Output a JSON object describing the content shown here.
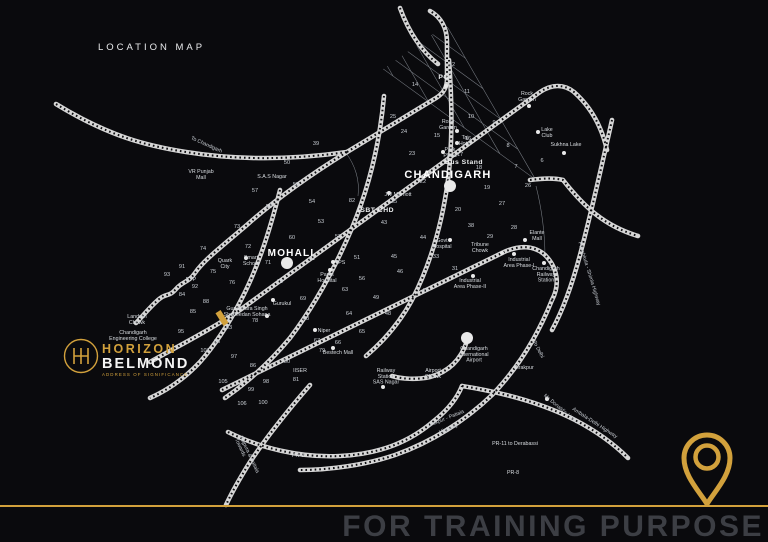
{
  "title": "LOCATION MAP",
  "watermark": "FOR TRAINING PURPOSE",
  "branding": {
    "monogram": "H",
    "name_line1": "HORIZON",
    "name_line2": "BELMOND",
    "tagline": "ADDRESS OF SIGNIFICANCE"
  },
  "colors": {
    "background": "#0a0a0d",
    "gold": "#d2a13c",
    "road": "#d6d6d6",
    "road_dash": "#0c0c0f",
    "grid_line": "#959ba3",
    "label": "#d9dde1",
    "watermark_text": "#3c3e44"
  },
  "map": {
    "grid": {
      "origin": [
        448,
        28
      ],
      "angle_a_deg": 216,
      "angle_b_deg": 60,
      "len_a": 420,
      "len_b": 175,
      "step_a": 44,
      "step_b": 35,
      "subdiv_from": 240,
      "clip_polygon": "450,22 544,186 218,424 114,258"
    },
    "roads": [
      "M56,104 C110,137 148,146 186,152 C248,162 305,158 347,152",
      "M347,152 L436,98 C444,93 447,87 447,79 L447,42 C447,28 441,17 430,11",
      "M400,8 C408,30 420,50 438,64",
      "M347,152 C310,175 275,200 248,224 C220,248 204,260 195,273 C188,283 183,281 176,289 C168,298 167,292 158,300 C148,309 143,316 136,323",
      "M150,362 C180,345 210,330 240,310 L540,92 C552,84 564,84 574,92 C592,108 602,128 607,150",
      "M222,390 L502,253 C520,244 535,246 545,255 C558,268 560,285 552,300",
      "M552,300 C538,335 518,368 492,395 C466,420 432,442 395,455 C365,465 330,470 300,470",
      "M449,60 C452,100 453,140 448,180 C442,225 430,265 412,300 C400,322 385,340 366,356",
      "M384,96 C380,140 370,185 352,228 C335,268 315,305 290,338 C270,362 248,382 225,398",
      "M280,190 C270,230 258,268 240,302 C228,325 215,345 200,362 C185,378 168,390 150,398",
      "M467,341 C461,360 448,372 430,377 C416,380 402,379 392,376",
      "M228,432 C260,448 300,458 340,456 C380,454 410,442 435,420 C450,408 458,396 462,386",
      "M310,385 C290,408 268,435 250,462 C240,478 232,492 226,505",
      "M462,386 C500,392 540,402 575,420 C598,432 615,445 628,458",
      "M612,120 C603,160 592,210 580,255 C572,285 563,310 552,330",
      "M530,180 C545,178 555,178 563,180 C585,208 605,226 638,236"
    ],
    "extra_thin": [
      "M346,153 C355,165 360,180 358,196",
      "M536,186 C542,210 545,235 545,258"
    ],
    "city_labels": [
      {
        "text": "CHANDIGARH",
        "x": 448,
        "y": 178,
        "size": 11
      },
      {
        "text": "MOHALI",
        "x": 291,
        "y": 256,
        "size": 10
      }
    ],
    "big_dots": [
      [
        450,
        186
      ],
      [
        287,
        263
      ],
      [
        467,
        338
      ]
    ],
    "site_marker": {
      "x": 222,
      "y": 318,
      "w": 6,
      "h": 15,
      "rot": -32
    },
    "sector_numbers": [
      [
        "12",
        452,
        66
      ],
      [
        "14",
        415,
        86
      ],
      [
        "11",
        467,
        93
      ],
      [
        "25",
        393,
        118
      ],
      [
        "10",
        471,
        118
      ],
      [
        "9",
        494,
        124
      ],
      [
        "24",
        404,
        133
      ],
      [
        "15",
        437,
        137
      ],
      [
        "16",
        468,
        140
      ],
      [
        "23",
        412,
        155
      ],
      [
        "8",
        508,
        147
      ],
      [
        "17",
        460,
        156
      ],
      [
        "18",
        479,
        169
      ],
      [
        "7",
        516,
        168
      ],
      [
        "6",
        542,
        162
      ],
      [
        "26",
        528,
        187
      ],
      [
        "22",
        423,
        183
      ],
      [
        "19",
        487,
        189
      ],
      [
        "35",
        394,
        203
      ],
      [
        "82",
        352,
        202
      ],
      [
        "20",
        458,
        211
      ],
      [
        "27",
        502,
        205
      ],
      [
        "38",
        471,
        227
      ],
      [
        "28",
        514,
        229
      ],
      [
        "29",
        490,
        238
      ],
      [
        "33",
        436,
        258
      ],
      [
        "31",
        455,
        270
      ],
      [
        "39",
        316,
        145
      ],
      [
        "50",
        287,
        164
      ],
      [
        "57",
        255,
        192
      ],
      [
        "55",
        296,
        186
      ],
      [
        "58",
        269,
        208
      ],
      [
        "54",
        312,
        203
      ],
      [
        "73",
        237,
        228
      ],
      [
        "53",
        321,
        223
      ],
      [
        "60",
        292,
        239
      ],
      [
        "52",
        338,
        238
      ],
      [
        "72",
        248,
        248
      ],
      [
        "74",
        203,
        250
      ],
      [
        "43",
        384,
        224
      ],
      [
        "44",
        423,
        239
      ],
      [
        "45",
        394,
        258
      ],
      [
        "51",
        357,
        259
      ],
      [
        "61",
        312,
        260
      ],
      [
        "71",
        268,
        264
      ],
      [
        "91",
        182,
        268
      ],
      [
        "75",
        213,
        273
      ],
      [
        "93",
        167,
        276
      ],
      [
        "FTP",
        191,
        281
      ],
      [
        "92",
        195,
        288
      ],
      [
        "76",
        232,
        284
      ],
      [
        "70",
        280,
        283
      ],
      [
        "56",
        362,
        280
      ],
      [
        "63",
        345,
        291
      ],
      [
        "46",
        400,
        273
      ],
      [
        "47",
        425,
        292
      ],
      [
        "49",
        376,
        299
      ],
      [
        "48",
        388,
        315
      ],
      [
        "84",
        182,
        296
      ],
      [
        "88",
        206,
        303
      ],
      [
        "85",
        193,
        313
      ],
      [
        "69",
        303,
        300
      ],
      [
        "78",
        255,
        322
      ],
      [
        "68",
        306,
        320
      ],
      [
        "83",
        229,
        329
      ],
      [
        "95",
        181,
        333
      ],
      [
        "96",
        217,
        343
      ],
      [
        "107",
        205,
        352
      ],
      [
        "97",
        234,
        358
      ],
      [
        "86",
        253,
        367
      ],
      [
        "79",
        322,
        352
      ],
      [
        "66",
        338,
        344
      ],
      [
        "67",
        317,
        342
      ],
      [
        "64",
        349,
        315
      ],
      [
        "65",
        362,
        333
      ],
      [
        "80",
        287,
        363
      ],
      [
        "81",
        296,
        381
      ],
      [
        "98",
        266,
        383
      ],
      [
        "105",
        223,
        383
      ],
      [
        "99",
        251,
        391
      ],
      [
        "106",
        242,
        405
      ],
      [
        "100",
        263,
        404
      ]
    ],
    "poi_labels": [
      {
        "lines": [
          "PGI"
        ],
        "x": 445,
        "y": 79,
        "dot": [
          446,
          86
        ],
        "bold": true
      },
      {
        "lines": [
          "Rock",
          "Garden"
        ],
        "x": 527,
        "y": 95,
        "dot": [
          529,
          106
        ]
      },
      {
        "lines": [
          "Rose",
          "Garden"
        ],
        "x": 448,
        "y": 123,
        "dot": [
          457,
          131
        ]
      },
      {
        "lines": [
          "Lake",
          "Club"
        ],
        "x": 547,
        "y": 131,
        "dot": [
          538,
          132
        ]
      },
      {
        "lines": [
          "Sukhna Lake"
        ],
        "x": 566,
        "y": 146,
        "dot": [
          564,
          153
        ]
      },
      {
        "lines": [
          "Taj",
          "Hotel"
        ],
        "x": 465,
        "y": 139,
        "dot": [
          457,
          143
        ]
      },
      {
        "lines": [
          "Park",
          "Plaza"
        ],
        "x": 450,
        "y": 151,
        "dot": [
          443,
          152
        ]
      },
      {
        "lines": [
          "Bus Stand"
        ],
        "x": 464,
        "y": 164,
        "bold": true
      },
      {
        "lines": [
          "JW Marriott"
        ],
        "x": 398,
        "y": 196,
        "dot": [
          389,
          193
        ]
      },
      {
        "lines": [
          "ISBT CHD"
        ],
        "x": 376,
        "y": 212,
        "bold": true
      },
      {
        "lines": [
          "Govt",
          "Hospital"
        ],
        "x": 442,
        "y": 242,
        "dot": [
          450,
          240
        ]
      },
      {
        "lines": [
          "Tribune",
          "Chowk"
        ],
        "x": 480,
        "y": 246,
        "dot": [
          502,
          253
        ]
      },
      {
        "lines": [
          "Elante",
          "Mall"
        ],
        "x": 537,
        "y": 234,
        "dot": [
          525,
          240
        ]
      },
      {
        "lines": [
          "Industrial",
          "Area Phase-I"
        ],
        "x": 519,
        "y": 261,
        "dot": [
          514,
          254
        ]
      },
      {
        "lines": [
          "Industrial",
          "Area Phase-II"
        ],
        "x": 470,
        "y": 282,
        "dot": [
          473,
          276
        ]
      },
      {
        "lines": [
          "Chandigarh",
          "Railway",
          "Station"
        ],
        "x": 546,
        "y": 270,
        "dot": [
          544,
          263
        ]
      },
      {
        "lines": [
          "Smart",
          "School"
        ],
        "x": 251,
        "y": 259,
        "dot": [
          246,
          258
        ]
      },
      {
        "lines": [
          "Quark",
          "City"
        ],
        "x": 225,
        "y": 262
      },
      {
        "lines": [
          "YPS"
        ],
        "x": 340,
        "y": 264,
        "dot": [
          333,
          262
        ]
      },
      {
        "lines": [
          "Parks",
          "Hospital"
        ],
        "x": 327,
        "y": 276,
        "dot": [
          330,
          270
        ]
      },
      {
        "lines": [
          "Gurukul"
        ],
        "x": 282,
        "y": 305,
        "dot": [
          273,
          300
        ]
      },
      {
        "lines": [
          "Gurudwara Singh",
          "Shaheedan Sohana"
        ],
        "x": 247,
        "y": 310,
        "dot": [
          267,
          316
        ]
      },
      {
        "lines": [
          "Niper"
        ],
        "x": 324,
        "y": 332,
        "dot": [
          315,
          330
        ]
      },
      {
        "lines": [
          "Bestech Mall"
        ],
        "x": 338,
        "y": 354,
        "dot": [
          333,
          348
        ]
      },
      {
        "lines": [
          "IISER"
        ],
        "x": 300,
        "y": 372
      },
      {
        "lines": [
          "Railway",
          "Station",
          "SAS Nagar"
        ],
        "x": 386,
        "y": 372,
        "dot": [
          383,
          387
        ]
      },
      {
        "lines": [
          "Airport",
          "Chowk"
        ],
        "x": 433,
        "y": 372
      },
      {
        "lines": [
          "Chandigarh",
          "International",
          "Airport"
        ],
        "x": 474,
        "y": 350
      },
      {
        "lines": [
          "Zirakpur"
        ],
        "x": 524,
        "y": 369
      },
      {
        "lines": [
          "VR Punjab",
          "Mall"
        ],
        "x": 201,
        "y": 173
      },
      {
        "lines": [
          "S.A.S Nagar"
        ],
        "x": 272,
        "y": 178
      },
      {
        "lines": [
          "Landran",
          "Chowk"
        ],
        "x": 137,
        "y": 318
      },
      {
        "lines": [
          "Chandigarh",
          "Engineering College"
        ],
        "x": 133,
        "y": 334
      },
      {
        "lines": [
          "PR-11 to Derabassi"
        ],
        "x": 515,
        "y": 445
      },
      {
        "lines": [
          "PR-8"
        ],
        "x": 513,
        "y": 474
      },
      {
        "lines": [
          "PR-9"
        ],
        "x": 298,
        "y": 457
      }
    ],
    "rotated_labels": [
      {
        "text": "To Chandigarh",
        "x": 206,
        "y": 146,
        "rot": 24
      },
      {
        "text": "Panchkula - Shimla Highway",
        "x": 588,
        "y": 274,
        "rot": 73
      },
      {
        "text": "To Delhi",
        "x": 537,
        "y": 350,
        "rot": 62
      },
      {
        "text": "Mc Donald's / KFC",
        "x": 560,
        "y": 410,
        "rot": 40
      },
      {
        "text": "Ambala-Delhi Highway",
        "x": 594,
        "y": 424,
        "rot": 33
      },
      {
        "text": "Zirakpur - Patiala",
        "x": 446,
        "y": 420,
        "rot": -22
      },
      {
        "text": "Highway",
        "x": 449,
        "y": 430,
        "rot": -22
      },
      {
        "text": "Towards",
        "x": 239,
        "y": 448,
        "rot": 65
      },
      {
        "text": "Rajpura & Patiala",
        "x": 248,
        "y": 455,
        "rot": 65
      }
    ],
    "small_road_dots": [
      [
        547,
        399
      ]
    ]
  }
}
